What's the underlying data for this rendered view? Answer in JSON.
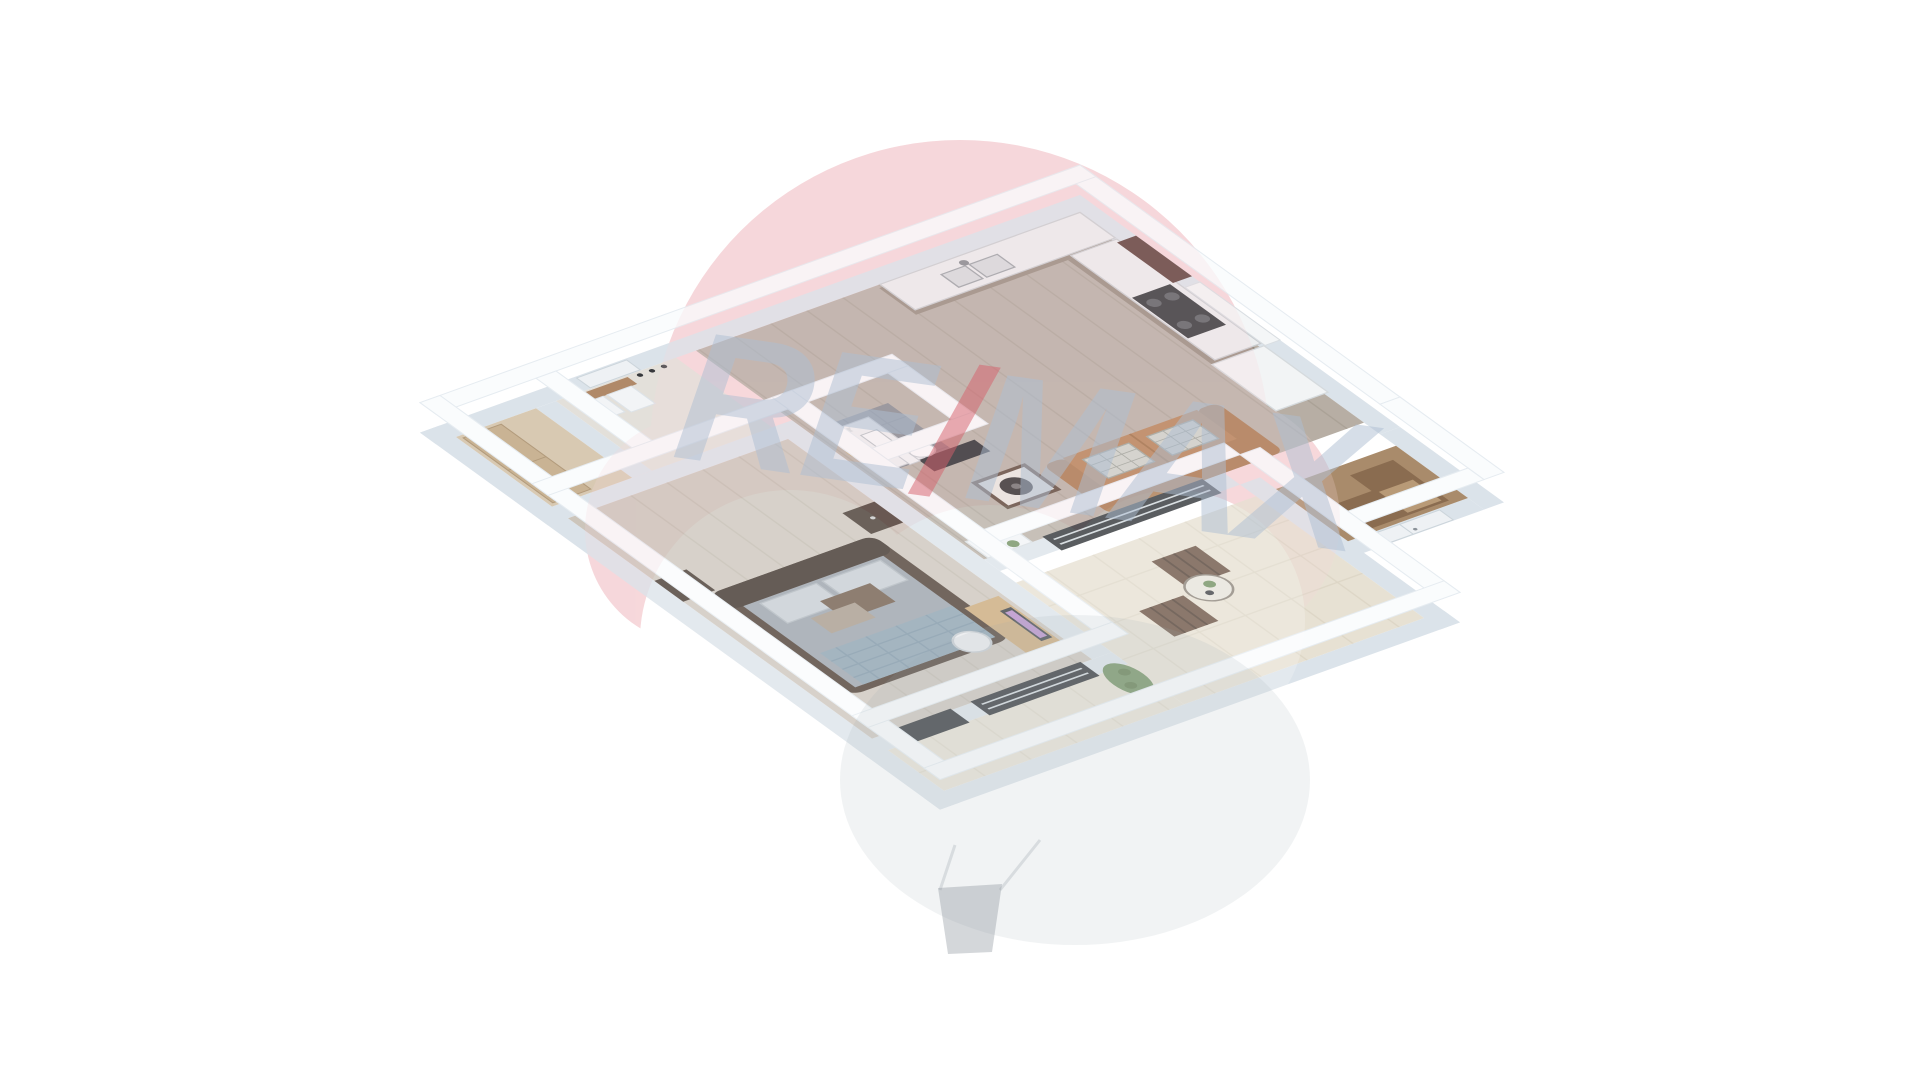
{
  "watermark": {
    "text_left": "RE",
    "text_slash": "/",
    "text_right": "MAX",
    "balloon_color": "#f7d8db",
    "text_color": "#aebfd3",
    "slash_color": "#d6606b",
    "basket_color": "#8f979e"
  },
  "palette": {
    "background": "#ffffff",
    "wall_top": "#fafcfd",
    "wall_side": "#dbe3ea",
    "floor_living": "#b7aea4",
    "floor_bedroom": "#ccc5bb",
    "floor_bathroom": "#82878f",
    "floor_hall": "#e3e0da",
    "floor_closet": "#d8c9b2",
    "floor_storage": "#a98b6b",
    "floor_terrace": "#e7e1d3",
    "sofa": "#b58055",
    "sofa_dark": "#a8764b",
    "bed_frame": "#4a3b31",
    "bed_duvet": "#99a1aa",
    "bed_plaid": "#8ba0af",
    "kitchen_counter": "#eceeef",
    "kitchen_base": "#958a7d",
    "upper_cabinet": "#5a3a35",
    "vanity": "#2e3a4a",
    "mirror_gold": "#c9a15a",
    "outdoor_chair": "#6a5243",
    "plant": "#6f8f5f",
    "glass_door": "#2b2f33",
    "desk_wood": "#c9a878",
    "nightstand": "#41342c",
    "coat_rack": "#b08968",
    "monitor_screen": "#b58cc8"
  },
  "rooms": [
    {
      "name": "bedroom"
    },
    {
      "name": "hallway"
    },
    {
      "name": "closet"
    },
    {
      "name": "bathroom"
    },
    {
      "name": "kitchen"
    },
    {
      "name": "living-room"
    },
    {
      "name": "storage-room"
    },
    {
      "name": "terrace"
    }
  ],
  "furniture": [
    "double-bed",
    "nightstand",
    "desk",
    "desk-chair",
    "monitor",
    "coat-rack",
    "wardrobe",
    "vanity",
    "arch-mirror",
    "toilet",
    "flower-vase",
    "kitchen-counter",
    "sink",
    "cooktop",
    "upper-cabinets",
    "tall-cabinet",
    "sofa",
    "coffee-table",
    "tv",
    "plant-shelf",
    "outdoor-chair",
    "bistro-table",
    "planter",
    "sliding-glass-door",
    "entry-double-door",
    "hall-door"
  ]
}
